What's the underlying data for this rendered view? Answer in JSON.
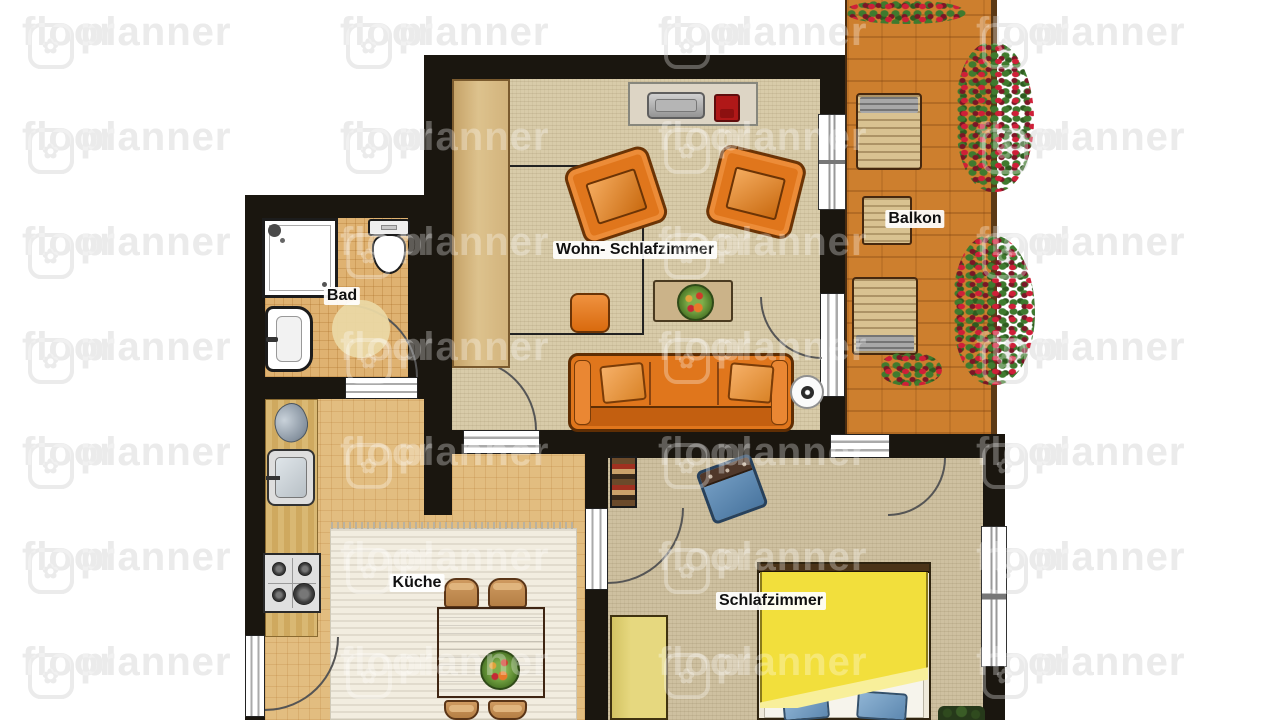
{
  "watermark": {
    "left": "floor",
    "right": "planner",
    "logo_icon": "✿"
  },
  "rooms": {
    "living": {
      "label": "Wohn- Schlafzimmer"
    },
    "balcony": {
      "label": "Balkon"
    },
    "bathroom": {
      "label": "Bad"
    },
    "kitchen": {
      "label": "Küche"
    },
    "bedroom": {
      "label": "Schlafzimmer"
    }
  },
  "colors": {
    "wall": "#1a160f",
    "floor-living": "#d8cba9",
    "floor-bedroom": "#cec0a0",
    "floor-bath": "#dfb271",
    "floor-kitchen": "#e2bd80",
    "brick": "#cd7f2e",
    "orange": "#e0761c",
    "orange-dark": "#6b3406",
    "bed-yellow": "#f2df3c",
    "wardrobe-yellow": "#e6d87f",
    "wardrobe-tan": "#d2b37c",
    "chair-blue": "#4a76a0",
    "rug": "#f2ede0",
    "lounger": "#d9c291",
    "flower": "#cf1f38",
    "leaf": "#3f7a2e",
    "redpot": "#b01818"
  }
}
